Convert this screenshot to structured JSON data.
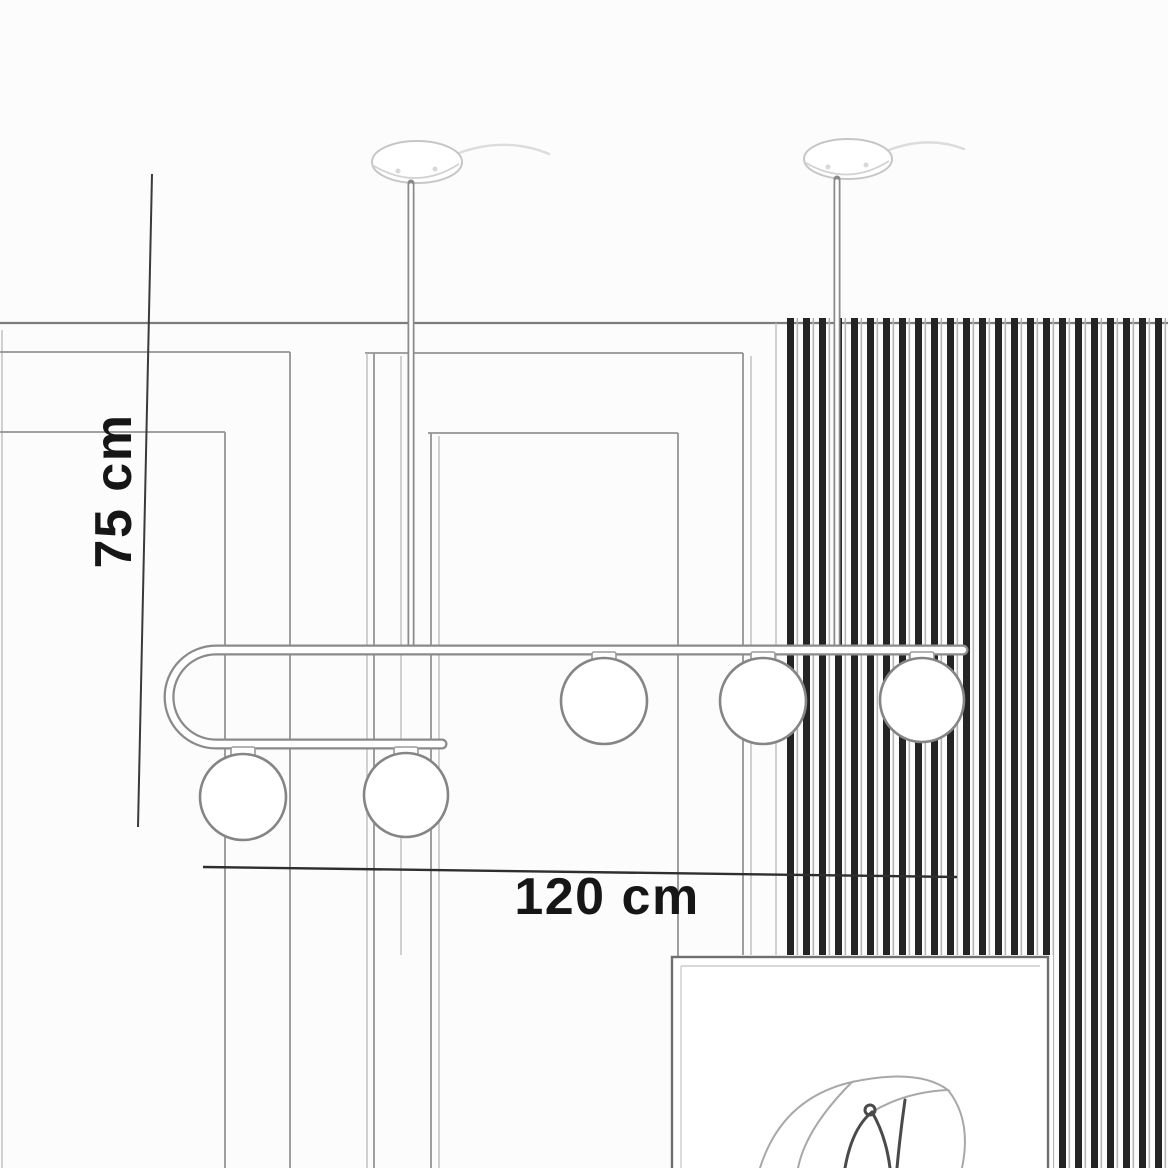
{
  "image": {
    "type": "product-dimension-sketch",
    "subject": "Ceiling-mounted linear pendant chandelier with looped bar and opal glass globes, drawn over a sketched interior wall with vertical slat paneling and a framed artwork"
  },
  "dimensions": {
    "height": {
      "label": "75 cm"
    },
    "width": {
      "label": "120 cm"
    }
  },
  "fixture": {
    "globes_total": 5,
    "globes_on_upper_bar": 3,
    "globes_on_lower_bar": 2,
    "ceiling_canopies": 2
  },
  "colors": {
    "ink": "#161616",
    "paper": "#fcfcfc",
    "sketch_line": "#949494",
    "slat_dark": "#242424",
    "fixture_line": "#8a8a8a"
  }
}
